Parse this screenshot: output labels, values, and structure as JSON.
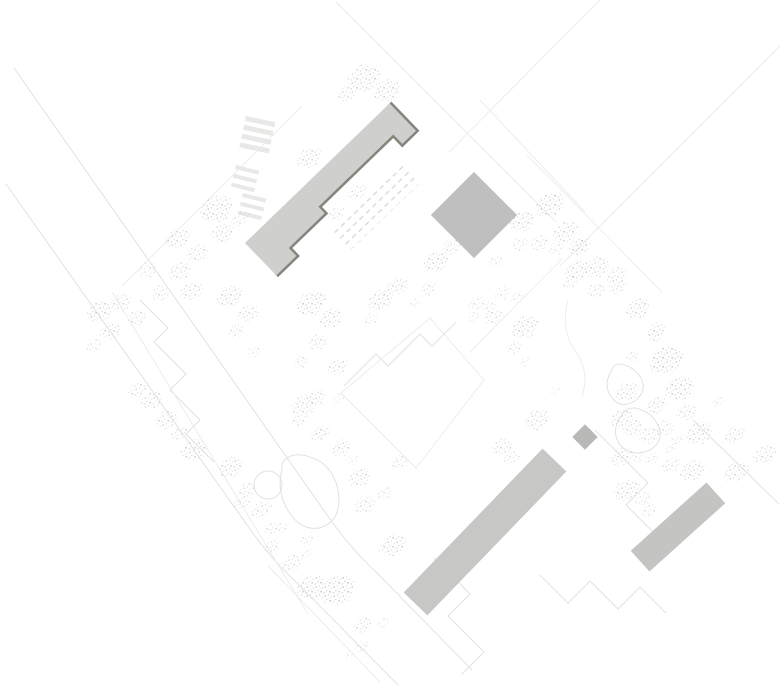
{
  "canvas": {
    "width": 780,
    "height": 685,
    "background": "#ffffff"
  },
  "palette": {
    "building_main": "#cfcfcd",
    "building_shadow": "#85857b",
    "building_block": "#bfbfbf",
    "building_bar": "#c7c7c5",
    "building_bar2": "#c4c4c2",
    "building_small": "#b9b9b7",
    "line": "#e2e2e0",
    "line_light": "#ededeb",
    "stripe": "#e8e8e6",
    "ladder": "#d9d9d7",
    "tree_dot_dark": "#b7b7b5",
    "tree_dot_mid": "#cdcdcb",
    "tree_dot_light": "#e0e0de"
  },
  "roads": [
    {
      "d": "M 14,68 L 332,522 Q 354,552 378,574 L 472,670"
    },
    {
      "d": "M 6,184 L 252,532 Q 274,562 298,584 L 398,685"
    },
    {
      "d": "M 302,106 L 122,286",
      "light": true
    },
    {
      "d": "M 336,2 L 556,222",
      "light": true
    },
    {
      "d": "M 527,155 L 662,292",
      "light": true
    },
    {
      "d": "M 600,0 L 449,152",
      "light": true
    },
    {
      "d": "M 780,46 L 560,266",
      "light": true
    },
    {
      "d": "M 480,100 L 585,212",
      "light": true
    },
    {
      "d": "M 430,318 L 484,380 L 416,468 L 341,393 Z",
      "light": true
    },
    {
      "d": "M 140,300 L 168,328 L 154,342 L 186,374 L 170,390 L 200,420 L 186,434 L 214,462"
    },
    {
      "d": "M 344,386 L 376,354 L 388,366 L 420,334 L 432,346 L 456,322"
    },
    {
      "d": "M 434,558 L 470,594 L 448,616 L 484,652 L 462,674"
    },
    {
      "d": "M 540,575 L 568,603 L 590,581 L 618,609 L 640,587 L 666,613"
    },
    {
      "d": "M 595,430 L 648,483 L 626,505 L 652,531"
    },
    {
      "d": "M 693,420 L 779,504"
    },
    {
      "d": "M 282,469 Q 276,492 289,512 Q 301,531 319,528 Q 339,523 339,499 Q 338,475 321,462 Q 299,450 287,458 Q 281,462 282,469 Z"
    },
    {
      "d": "M 612,370 Q 602,385 612,398 Q 622,410 636,400 Q 648,390 640,376 Q 630,364 618,364 Q 613,365 612,370 Z"
    },
    {
      "d": "M 622,415 Q 610,430 620,445 Q 632,458 650,450 Q 665,441 658,425 Q 650,410 634,408 Q 625,408 622,415 Z"
    },
    {
      "d": "M 568,300 Q 560,330 576,352 Q 590,372 582,396",
      "light": true
    },
    {
      "d": "M 112,292 L 308,614",
      "light": true
    },
    {
      "d": "M 268,471 a 14,14 0 1 0 0.1,0 Z"
    },
    {
      "d": "M 563,258 L 470,352",
      "light": true
    },
    {
      "d": "M 268,566 L 380,682",
      "light": true
    }
  ],
  "crosswalks": [
    {
      "x": 246,
      "y": 116,
      "angle": 12,
      "bars": 4,
      "bar_w": 30,
      "bar_h": 5,
      "gap": 4
    },
    {
      "x": 236,
      "y": 165,
      "angle": 14,
      "bars": 3,
      "bar_w": 24,
      "bar_h": 4,
      "gap": 5
    },
    {
      "x": 243,
      "y": 193,
      "angle": 14,
      "bars": 3,
      "bar_w": 24,
      "bar_h": 4,
      "gap": 5
    }
  ],
  "ladders": [
    {
      "x": 332,
      "y": 232,
      "angle": -44,
      "w": 100,
      "h": 26
    }
  ],
  "buildings": [
    {
      "kind": "rect",
      "cx": 474,
      "cy": 215,
      "w": 61,
      "h": 61,
      "angle": 45,
      "fill_key": "building_block"
    },
    {
      "kind": "rect",
      "cx": 485,
      "cy": 532,
      "w": 200,
      "h": 33,
      "angle": -46,
      "fill_key": "building_bar"
    },
    {
      "kind": "rect",
      "cx": 678,
      "cy": 527,
      "w": 102,
      "h": 28,
      "angle": -42,
      "fill_key": "building_bar2"
    },
    {
      "kind": "rect",
      "cx": 585,
      "cy": 437,
      "w": 18,
      "h": 18,
      "angle": 45,
      "fill_key": "building_small"
    }
  ],
  "main_building": {
    "x": 245,
    "y": 243,
    "angle": -44,
    "points": [
      [
        0,
        0
      ],
      [
        201,
        0
      ],
      [
        201,
        38
      ],
      [
        182,
        38
      ],
      [
        182,
        25
      ],
      [
        78,
        25
      ],
      [
        78,
        34
      ],
      [
        28,
        34
      ],
      [
        28,
        45
      ],
      [
        0,
        45
      ]
    ],
    "shadow_from_index": 1,
    "shadow_width": 5
  },
  "trees": [
    [
      365,
      78,
      16,
      0.8
    ],
    [
      388,
      90,
      13,
      0.75
    ],
    [
      347,
      94,
      9,
      0.6
    ],
    [
      310,
      158,
      12,
      0.7
    ],
    [
      217,
      209,
      16,
      0.8
    ],
    [
      223,
      233,
      11,
      0.7
    ],
    [
      241,
      219,
      9,
      0.55
    ],
    [
      178,
      239,
      12,
      0.7
    ],
    [
      198,
      253,
      10,
      0.65
    ],
    [
      180,
      271,
      11,
      0.7
    ],
    [
      148,
      270,
      9,
      0.55
    ],
    [
      192,
      291,
      11,
      0.65
    ],
    [
      161,
      293,
      9,
      0.55
    ],
    [
      100,
      312,
      12,
      0.75
    ],
    [
      121,
      303,
      10,
      0.65
    ],
    [
      137,
      318,
      9,
      0.6
    ],
    [
      111,
      331,
      10,
      0.7
    ],
    [
      95,
      345,
      8,
      0.55
    ],
    [
      230,
      296,
      12,
      0.75
    ],
    [
      249,
      313,
      10,
      0.65
    ],
    [
      237,
      331,
      8,
      0.55
    ],
    [
      254,
      352,
      7,
      0.5
    ],
    [
      312,
      303,
      14,
      0.8
    ],
    [
      331,
      318,
      11,
      0.75
    ],
    [
      318,
      342,
      9,
      0.65
    ],
    [
      301,
      362,
      7,
      0.55
    ],
    [
      338,
      367,
      10,
      0.7
    ],
    [
      358,
      192,
      9,
      0.6
    ],
    [
      337,
      214,
      8,
      0.55
    ],
    [
      381,
      300,
      12,
      0.75
    ],
    [
      398,
      286,
      10,
      0.65
    ],
    [
      371,
      319,
      7,
      0.5
    ],
    [
      437,
      262,
      12,
      0.75
    ],
    [
      452,
      247,
      9,
      0.6
    ],
    [
      429,
      289,
      8,
      0.55
    ],
    [
      415,
      303,
      6,
      0.45
    ],
    [
      523,
      221,
      12,
      0.75
    ],
    [
      551,
      205,
      14,
      0.8
    ],
    [
      566,
      232,
      12,
      0.75
    ],
    [
      520,
      244,
      8,
      0.55
    ],
    [
      540,
      243,
      9,
      0.6
    ],
    [
      579,
      247,
      10,
      0.65
    ],
    [
      557,
      248,
      8,
      0.55
    ],
    [
      578,
      270,
      12,
      0.75
    ],
    [
      598,
      267,
      12,
      0.7
    ],
    [
      617,
      275,
      10,
      0.65
    ],
    [
      618,
      287,
      9,
      0.6
    ],
    [
      597,
      290,
      9,
      0.6
    ],
    [
      497,
      261,
      7,
      0.5
    ],
    [
      503,
      293,
      8,
      0.55
    ],
    [
      517,
      297,
      7,
      0.5
    ],
    [
      490,
      308,
      7,
      0.5
    ],
    [
      475,
      317,
      6,
      0.45
    ],
    [
      582,
      245,
      9,
      0.55
    ],
    [
      570,
      281,
      8,
      0.55
    ],
    [
      638,
      308,
      12,
      0.7
    ],
    [
      657,
      330,
      9,
      0.6
    ],
    [
      633,
      357,
      6,
      0.45
    ],
    [
      667,
      360,
      16,
      0.85
    ],
    [
      680,
      388,
      14,
      0.8
    ],
    [
      627,
      392,
      11,
      0.7
    ],
    [
      657,
      405,
      10,
      0.65
    ],
    [
      687,
      412,
      10,
      0.65
    ],
    [
      718,
      402,
      6,
      0.45
    ],
    [
      622,
      418,
      11,
      0.7
    ],
    [
      633,
      428,
      10,
      0.65
    ],
    [
      650,
      435,
      10,
      0.65
    ],
    [
      665,
      428,
      9,
      0.6
    ],
    [
      700,
      433,
      13,
      0.75
    ],
    [
      678,
      440,
      7,
      0.5
    ],
    [
      671,
      448,
      6,
      0.45
    ],
    [
      622,
      457,
      11,
      0.65
    ],
    [
      638,
      457,
      6,
      0.45
    ],
    [
      652,
      458,
      7,
      0.5
    ],
    [
      735,
      435,
      10,
      0.65
    ],
    [
      765,
      455,
      11,
      0.65
    ],
    [
      672,
      465,
      9,
      0.55
    ],
    [
      693,
      470,
      12,
      0.7
    ],
    [
      737,
      472,
      12,
      0.7
    ],
    [
      627,
      490,
      13,
      0.75
    ],
    [
      643,
      499,
      8,
      0.55
    ],
    [
      655,
      335,
      8,
      0.55
    ],
    [
      632,
      355,
      5,
      0.4
    ],
    [
      649,
      511,
      8,
      0.55
    ],
    [
      340,
      398,
      6,
      0.45
    ],
    [
      300,
      420,
      8,
      0.55
    ],
    [
      320,
      433,
      9,
      0.6
    ],
    [
      342,
      448,
      10,
      0.65
    ],
    [
      352,
      460,
      6,
      0.45
    ],
    [
      360,
      477,
      11,
      0.7
    ],
    [
      365,
      505,
      10,
      0.65
    ],
    [
      385,
      493,
      8,
      0.55
    ],
    [
      477,
      303,
      8,
      0.55
    ],
    [
      493,
      317,
      9,
      0.6
    ],
    [
      525,
      327,
      13,
      0.75
    ],
    [
      515,
      347,
      8,
      0.55
    ],
    [
      525,
      362,
      6,
      0.45
    ],
    [
      537,
      420,
      12,
      0.7
    ],
    [
      503,
      447,
      10,
      0.65
    ],
    [
      512,
      458,
      8,
      0.55
    ],
    [
      555,
      390,
      5,
      0.4
    ],
    [
      400,
      462,
      8,
      0.55
    ],
    [
      138,
      390,
      9,
      0.65
    ],
    [
      152,
      400,
      10,
      0.7
    ],
    [
      167,
      420,
      11,
      0.7
    ],
    [
      180,
      433,
      8,
      0.6
    ],
    [
      195,
      450,
      13,
      0.75
    ],
    [
      232,
      467,
      12,
      0.75
    ],
    [
      247,
      490,
      9,
      0.6
    ],
    [
      242,
      503,
      8,
      0.55
    ],
    [
      262,
      510,
      10,
      0.65
    ],
    [
      273,
      528,
      8,
      0.55
    ],
    [
      283,
      528,
      6,
      0.45
    ],
    [
      305,
      405,
      12,
      0.7
    ],
    [
      317,
      397,
      9,
      0.6
    ],
    [
      323,
      432,
      7,
      0.5
    ],
    [
      337,
      447,
      5,
      0.4
    ],
    [
      272,
      546,
      8,
      0.55
    ],
    [
      307,
      540,
      7,
      0.5
    ],
    [
      307,
      553,
      6,
      0.45
    ],
    [
      292,
      563,
      10,
      0.65
    ],
    [
      312,
      587,
      14,
      0.8
    ],
    [
      338,
      590,
      17,
      0.85
    ],
    [
      393,
      545,
      13,
      0.75
    ],
    [
      363,
      625,
      9,
      0.6
    ],
    [
      383,
      623,
      6,
      0.45
    ],
    [
      363,
      647,
      7,
      0.5
    ],
    [
      350,
      655,
      5,
      0.4
    ]
  ]
}
